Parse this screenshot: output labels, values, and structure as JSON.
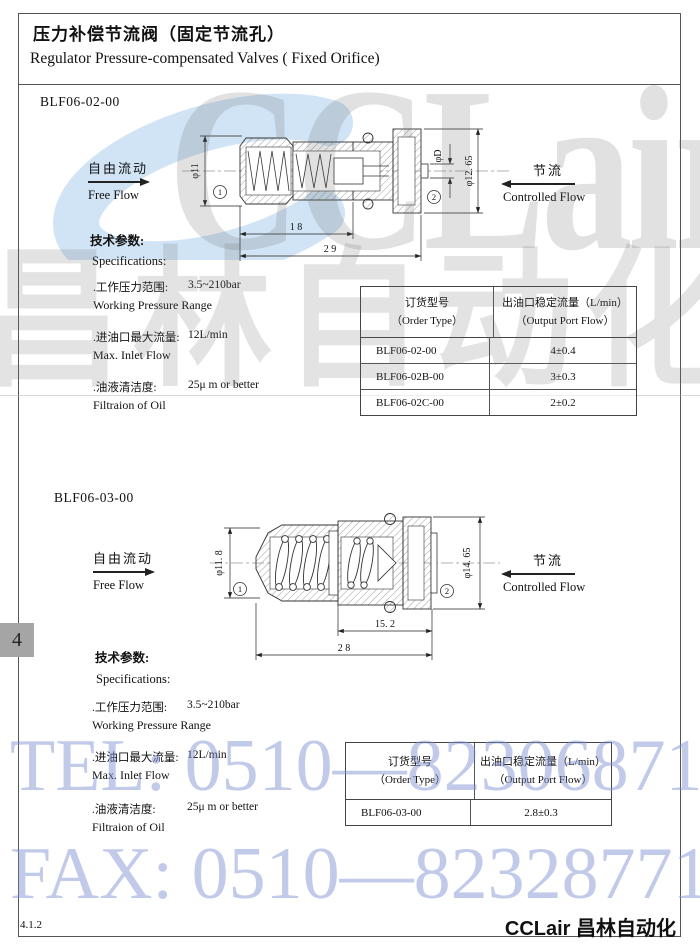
{
  "header": {
    "title_zh": "压力补偿节流阀（固定节流孔）",
    "title_en": "Regulator Pressure-compensated Valves ( Fixed Orifice)"
  },
  "page_tab": {
    "number": "4"
  },
  "footer": {
    "code": "4.1.2",
    "brand": "CCLair 昌林自动化"
  },
  "watermarks": {
    "logo_text": "CCLair",
    "logo_cjk": "昌林自动化",
    "tel": "TEL: 0510—82306871",
    "fax": "FAX: 0510—82328771",
    "blue_accent": "#c9dff3"
  },
  "sections": [
    {
      "model": "BLF06-02-00",
      "free_flow": {
        "zh": "自由流动",
        "en": "Free Flow"
      },
      "controlled_flow": {
        "zh": "节流",
        "en": "Controlled Flow"
      },
      "params_title": {
        "zh": "技术参数:",
        "en": "Specifications:"
      },
      "specs": [
        {
          "zh": ".工作压力范围:",
          "value": "3.5~210bar",
          "en": "Working Pressure Range"
        },
        {
          "zh": ".进油口最大流量:",
          "value": "12L/min",
          "en": "Max. Inlet Flow"
        },
        {
          "zh": ".油液清洁度:",
          "value": "25μ m or better",
          "en": "Filtraion of Oil"
        }
      ],
      "drawing": {
        "dia_left": "φ11",
        "dia_mid": "φD",
        "dia_right": "φ12. 65",
        "len_inner": "1 8",
        "len_total": "2 9",
        "port1": "1",
        "port2": "2"
      },
      "table": {
        "headers": {
          "col1_zh": "订货型号",
          "col1_en": "（Order Type）",
          "col2_zh": "出油口稳定流量（L/min）",
          "col2_en": "（Output Port Flow）"
        },
        "rows": [
          {
            "type": "BLF06-02-00",
            "flow": "4±0.4"
          },
          {
            "type": "BLF06-02B-00",
            "flow": "3±0.3"
          },
          {
            "type": "BLF06-02C-00",
            "flow": "2±0.2"
          }
        ]
      }
    },
    {
      "model": "BLF06-03-00",
      "free_flow": {
        "zh": "自由流动",
        "en": "Free Flow"
      },
      "controlled_flow": {
        "zh": "节流",
        "en": "Controlled Flow"
      },
      "params_title": {
        "zh": "技术参数:",
        "en": "Specifications:"
      },
      "specs": [
        {
          "zh": ".工作压力范围:",
          "value": "3.5~210bar",
          "en": "Working Pressure Range"
        },
        {
          "zh": ".进油口最大流量:",
          "value": "12L/min",
          "en": "Max. Inlet Flow"
        },
        {
          "zh": ".油液清洁度:",
          "value": "25μ m or better",
          "en": "Filtraion of Oil"
        }
      ],
      "drawing": {
        "dia_left": "φ11. 8",
        "dia_right": "φ14. 65",
        "len_inner": "15. 2",
        "len_total": "2 8",
        "port1": "1",
        "port2": "2"
      },
      "table": {
        "headers": {
          "col1_zh": "订货型号",
          "col1_en": "（Order Type）",
          "col2_zh": "出油口稳定流量（L/min）",
          "col2_en": "（Output Port Flow）"
        },
        "rows": [
          {
            "type": "BLF06-03-00",
            "flow": "2.8±0.3"
          }
        ]
      }
    }
  ]
}
